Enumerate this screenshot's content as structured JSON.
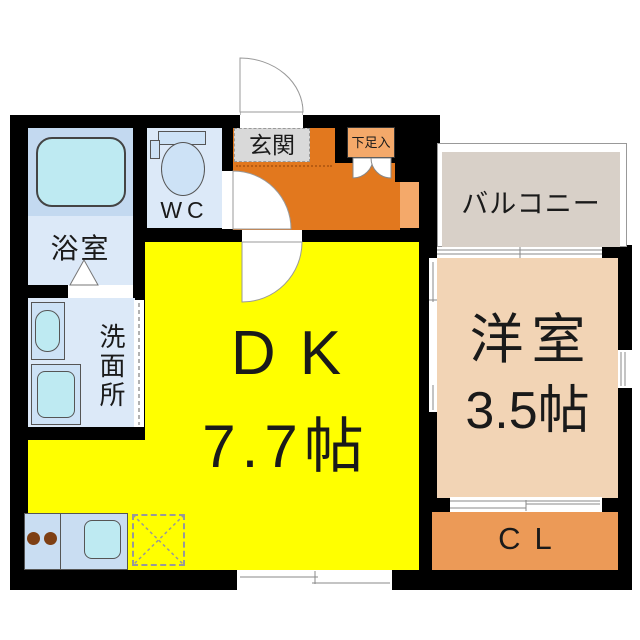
{
  "rooms": {
    "entrance": "玄関",
    "shoe_cabinet": "下足入",
    "toilet": "WC",
    "bathroom": "浴室",
    "washroom": "洗面所",
    "dk_label": "DK",
    "dk_size": "7.7帖",
    "western_label": "洋室",
    "western_size": "3.5帖",
    "balcony": "バルコニー",
    "closet": "CL"
  },
  "colors": {
    "wall": "#000000",
    "dk": "#FFFF00",
    "entrance": "#E2781E",
    "entrance-light": "#F4A96A",
    "closet": "#EC9A57",
    "western": "#F2D4B5",
    "balcony": "#D8D0C8",
    "wet-room": "#DCE9F8",
    "tub-zone": "#C3D9F0",
    "fixture-panel": "#CDE2F6",
    "fixture-cyan": "#BEEAF2",
    "counter": "#C9DDF2",
    "burner": "#7E3F14",
    "step-line": "#B85C12",
    "line": "#999999"
  }
}
